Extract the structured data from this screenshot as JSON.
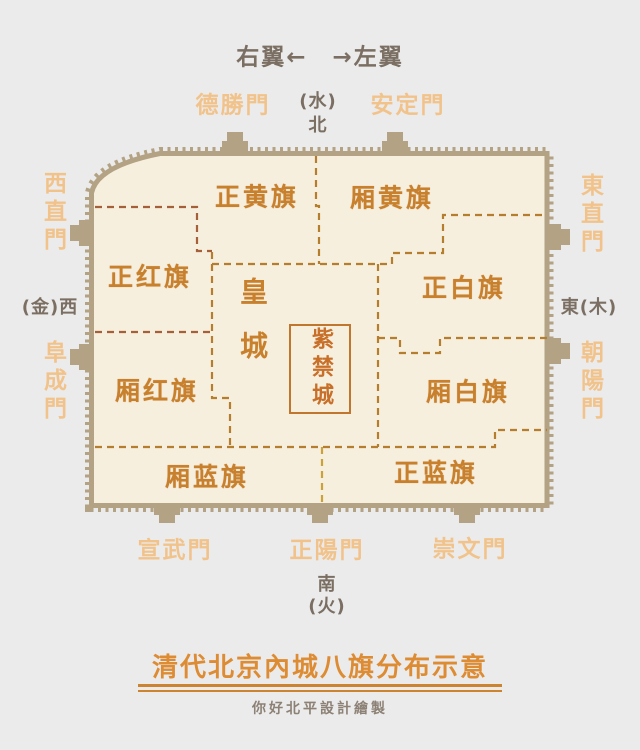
{
  "header": {
    "wings": "右翼←　→左翼"
  },
  "compass": {
    "north_element": "(水)",
    "north": "北",
    "west": "(金)西",
    "east": "東(木)",
    "south": "南",
    "south_element": "(火)"
  },
  "gates": {
    "deshengmen": "德勝門",
    "andingmen": "安定門",
    "xizhimen": "西直門",
    "fuchengmen": "阜成門",
    "dongzhimen": "東直門",
    "chaoyangmen": "朝陽門",
    "xuanwumen": "宣武門",
    "zhengyangmen": "正陽門",
    "chongwenmen": "崇文門"
  },
  "regions": {
    "plain_yellow": "正黄旗",
    "bordered_yellow": "厢黄旗",
    "plain_red": "正红旗",
    "bordered_red": "厢红旗",
    "plain_white": "正白旗",
    "bordered_white": "厢白旗",
    "plain_blue": "正蓝旗",
    "bordered_blue": "厢蓝旗",
    "imperial_city": "皇城",
    "forbidden_city": "紫禁城"
  },
  "footer": {
    "title": "清代北京內城八旗分布示意",
    "credit": "你好北平設計繪製"
  },
  "colors": {
    "background": "#ebebec",
    "map_fill": "#f7efdd",
    "wall": "#b3a284",
    "banner_label": "#c8802c",
    "gate_label": "#f1c38b",
    "compass_label": "#7b6f63",
    "dashed_line": "#b57d2e",
    "dashed_line_red": "#a5603a",
    "title": "#dd8c33",
    "credit": "#8d8175",
    "forbidden_city_border": "#c0762c"
  }
}
